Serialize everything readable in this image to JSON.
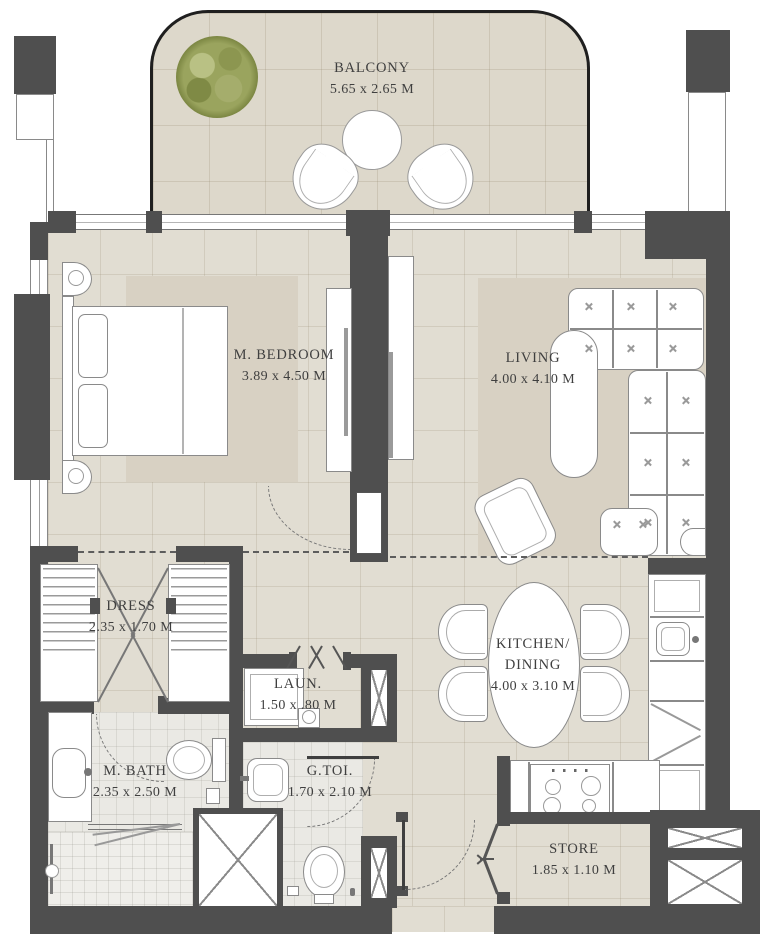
{
  "plan": {
    "rooms": {
      "balcony": {
        "name": "BALCONY",
        "dims": "5.65 x 2.65 M"
      },
      "bedroom": {
        "name": "M. BEDROOM",
        "dims": "3.89 x 4.50 M"
      },
      "living": {
        "name": "LIVING",
        "dims": "4.00 x 4.10 M"
      },
      "dress": {
        "name": "DRESS",
        "dims": "2.35 x 1.70 M"
      },
      "laundry": {
        "name": "LAUN.",
        "dims": "1.50 x .80 M"
      },
      "master_bath": {
        "name": "M. BATH",
        "dims": "2.35 x 2.50 M"
      },
      "guest_toilet": {
        "name": "G.TOI.",
        "dims": "1.70 x 2.10 M"
      },
      "kitchen_dining": {
        "name_line1": "KITCHEN/",
        "name_line2": "DINING",
        "dims": "4.00 x 3.10 M"
      },
      "store": {
        "name": "STORE",
        "dims": "1.85 x 1.10 M"
      }
    },
    "colors": {
      "wall": "#4f4f4f",
      "floor": "#e1ddd2",
      "rug": "#d8d1c3",
      "bath_floor": "#eae9e4",
      "balcony_outline": "#1f1f1f",
      "furniture_line": "#8a8a8a",
      "tree_green": "#93a050",
      "text": "#3f3f3f"
    }
  }
}
